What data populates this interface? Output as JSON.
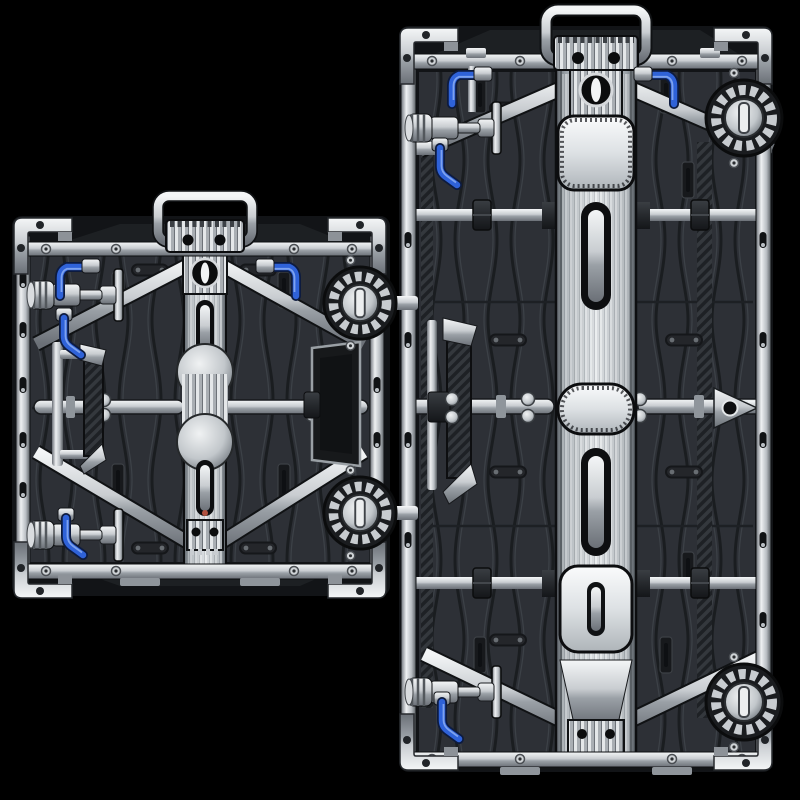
{
  "scene": {
    "type": "product-render",
    "subject": "rear view of two LED video wall cabinet panels on black background",
    "objects": [
      {
        "name": "led-cabinet-small",
        "shape": "square cabinet rear",
        "position": "front left, middle height"
      },
      {
        "name": "led-cabinet-large",
        "shape": "tall 1:2 cabinet rear",
        "position": "right, full height"
      }
    ],
    "parts": [
      "top-carry-handle",
      "ribbed-connector-block",
      "v-brace",
      "center-spine",
      "spine-plate",
      "spine-slot",
      "cross-rod",
      "cam-lock",
      "fastener-knob",
      "blue-release-lever",
      "carbon-grip-bar",
      "corner-bracket",
      "edge-rail",
      "wing-bracket",
      "back-plate"
    ]
  },
  "colors": {
    "background": "#000000",
    "panel_body": "#2d3036",
    "panel_groove": "#1a1d20",
    "panel_ridge": "#3c4147",
    "frame_dark": "#121417",
    "metal_bright": "#f2f4f5",
    "metal_mid": "#c3c8cc",
    "metal_shadow": "#878d93",
    "metal_dark": "#53585d",
    "accent_blue": "#2f62d8",
    "accent_blue_light": "#7da2ef",
    "accent_blue_dark": "#0d1b3f",
    "carbon_dark": "#1e2125",
    "carbon_light": "#34383d"
  }
}
